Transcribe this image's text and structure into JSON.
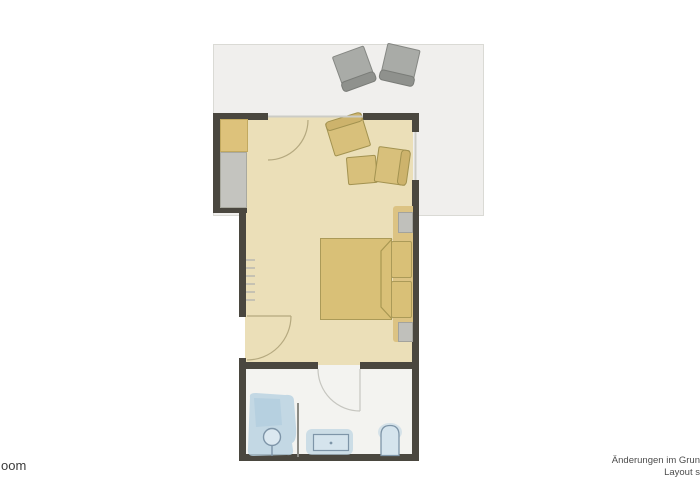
{
  "canvas": {
    "width": 700,
    "height": 500,
    "background": "#ffffff"
  },
  "annotations": {
    "left_cropped_label": "oom",
    "footer": {
      "line1": "Änderungen im Grun",
      "line2": "Layout s"
    }
  },
  "palette": {
    "wall": "#4a473f",
    "bedroom_floor": "#ebdfb8",
    "terrace_floor": "#f0efed",
    "bathroom_floor": "#f3f3f0",
    "wood_furniture_fill": "#d9c077",
    "wood_furniture_border": "#ab9a58",
    "wardrobe_fill": "#ddc27b",
    "gray_furniture_fill": "#c4c4bf",
    "terrace_chair_fill": "#a9aba7",
    "terrace_chair_border": "#858783",
    "fixture_blue": "#b7d1e1",
    "fixture_outline": "#7e95a8",
    "door_arc": "#b5a97f"
  },
  "floorplan": {
    "rooms": [
      {
        "name": "terrace",
        "furniture": [
          "terrace-chair-1",
          "terrace-chair-2"
        ]
      },
      {
        "name": "bedroom",
        "furniture": [
          "wardrobe",
          "dresser",
          "armchair-1",
          "side-table",
          "armchair-2",
          "double-bed",
          "pillow-left",
          "pillow-right",
          "nightstand-top",
          "nightstand-bottom",
          "radiator"
        ]
      },
      {
        "name": "bathroom",
        "furniture": [
          "shower",
          "shower-partition",
          "vanity-sink",
          "toilet"
        ]
      }
    ],
    "doors": [
      "terrace-door",
      "entry-door",
      "bathroom-door"
    ]
  }
}
